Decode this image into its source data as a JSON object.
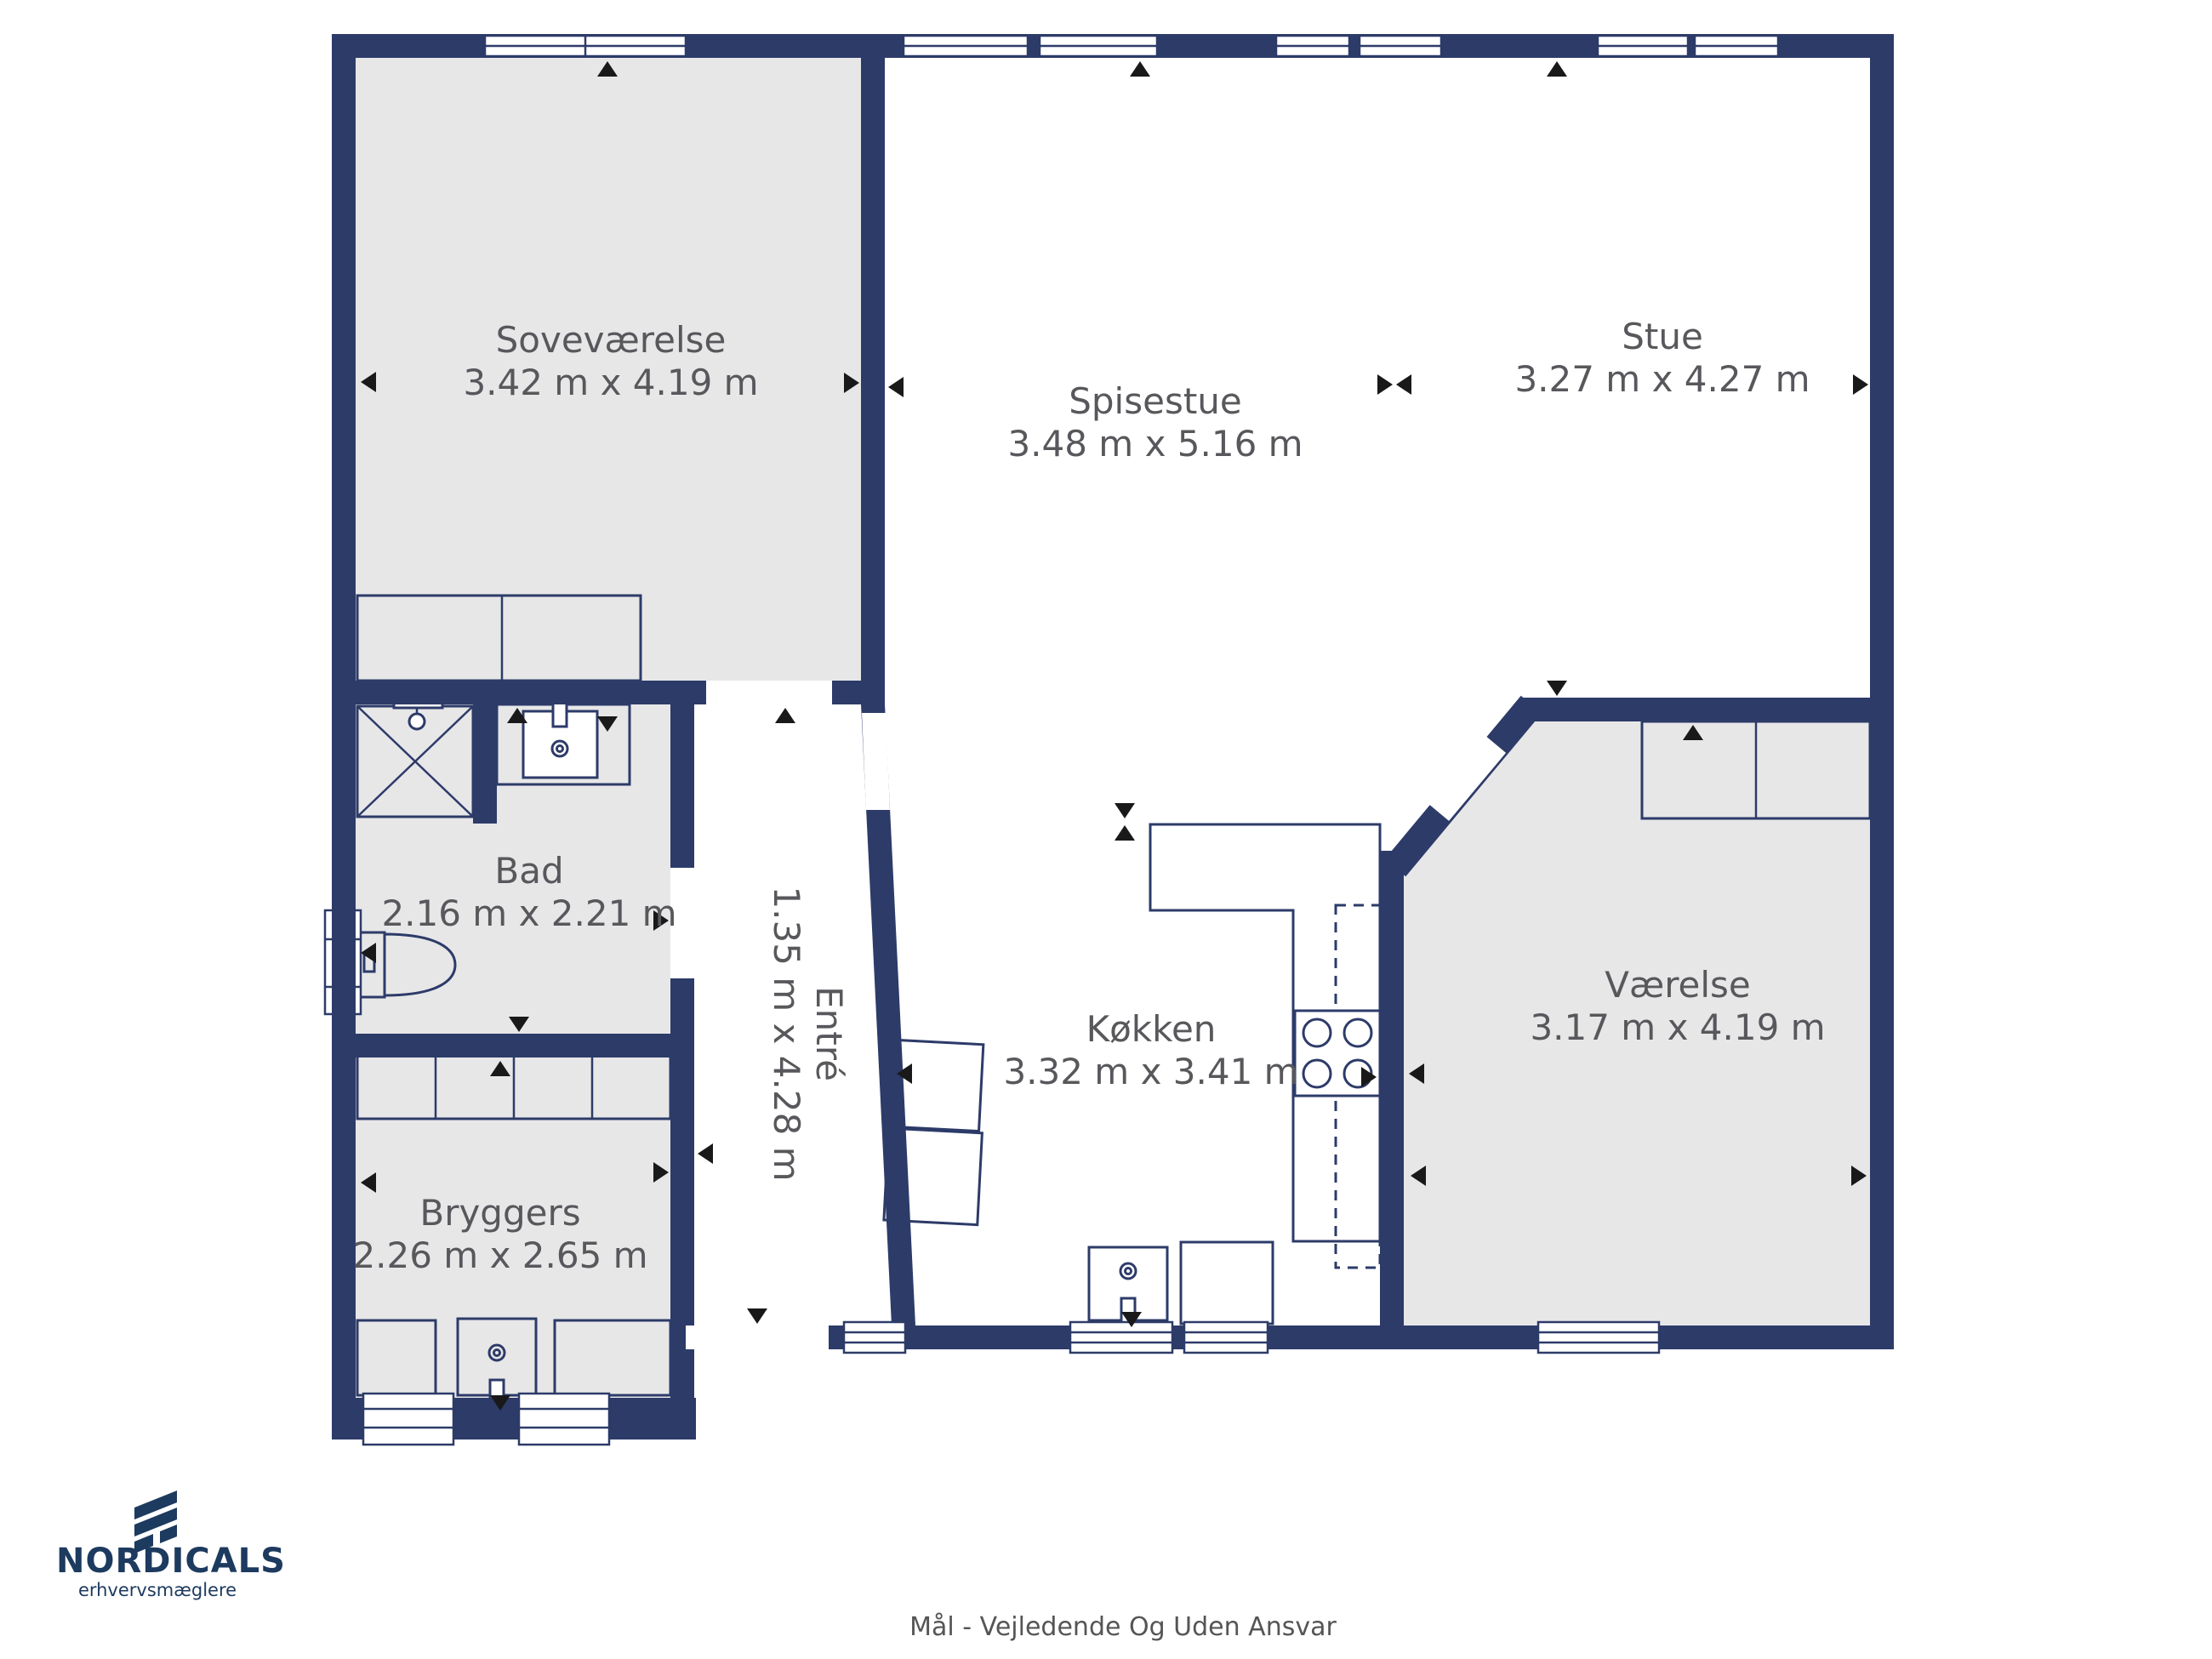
{
  "title": "Floor plan",
  "footer": {
    "disclaimer": "Mål - Vejledende Og Uden Ansvar"
  },
  "branding": {
    "name": "NORDICALS",
    "tagline": "erhvervsmæglere"
  },
  "colors": {
    "wall": "#2d3b69",
    "floor_gray": "#e7e7e8",
    "floor_white": "#ffffff",
    "label_text": "#58585c",
    "logo": "#1d3a5f",
    "marker": "#191919"
  },
  "rooms": [
    {
      "id": "sovevaerelse",
      "name": "Soveværelse",
      "dims": "3.42 m x 4.19 m"
    },
    {
      "id": "spisestue",
      "name": "Spisestue",
      "dims": "3.48 m x 5.16 m"
    },
    {
      "id": "stue",
      "name": "Stue",
      "dims": "3.27 m x 4.27 m"
    },
    {
      "id": "bad",
      "name": "Bad",
      "dims": "2.16 m x 2.21 m"
    },
    {
      "id": "entre",
      "name": "Entré",
      "dims": "1.35 m x 4.28 m"
    },
    {
      "id": "koekken",
      "name": "Køkken",
      "dims": "3.32 m x 3.41 m"
    },
    {
      "id": "vaerelse",
      "name": "Værelse",
      "dims": "3.17 m x 4.19 m"
    },
    {
      "id": "bryggers",
      "name": "Bryggers",
      "dims": "2.26 m x 2.65 m"
    }
  ]
}
